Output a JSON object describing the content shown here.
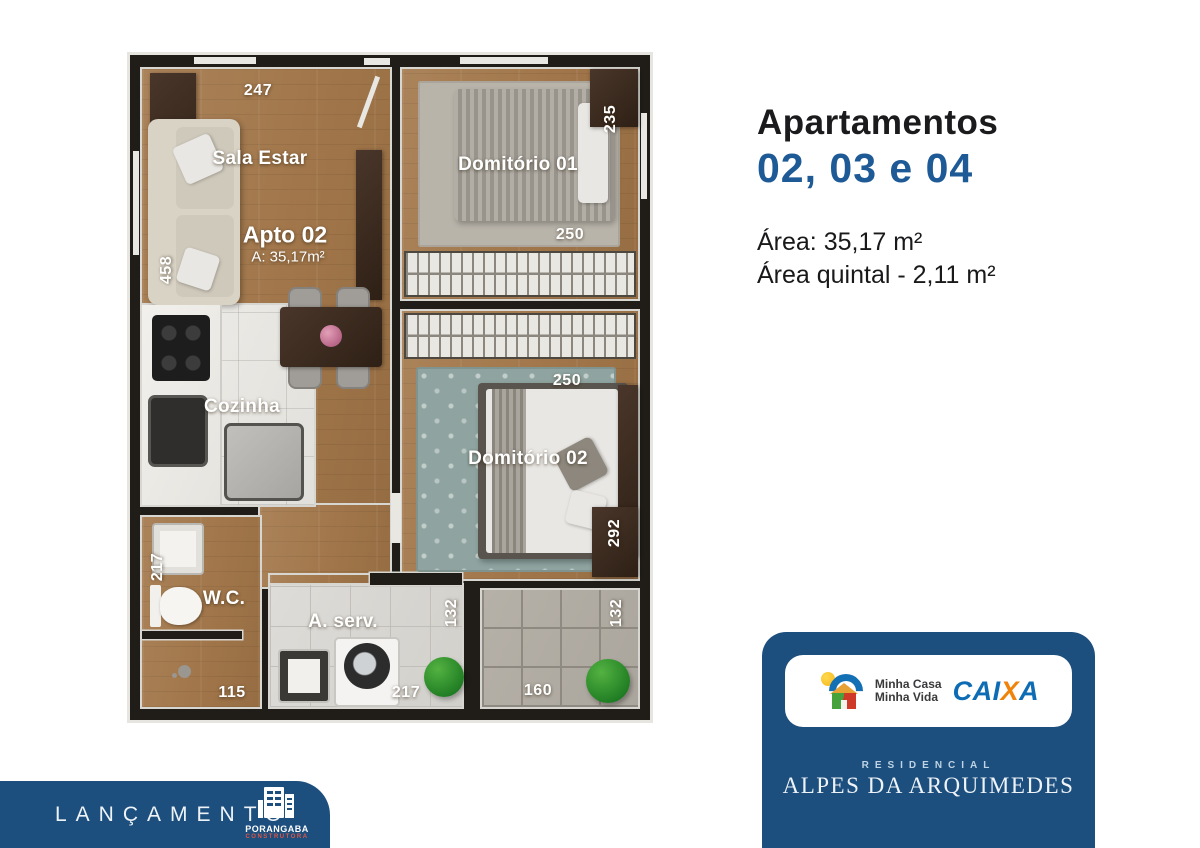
{
  "right_panel": {
    "title": "Apartamentos",
    "units": "02, 03 e 04",
    "area_line1": "Área: 35,17 m²",
    "area_line2": "Área quintal - 2,11 m²",
    "units_color": "#1e5a96"
  },
  "floorplan": {
    "labels": {
      "sala": "Sala Estar",
      "apto": "Apto 02",
      "apto_area": "A: 35,17m²",
      "dorm1": "Domitório 01",
      "dorm2": "Domitório 02",
      "cozinha": "Cozinha",
      "wc": "W.C.",
      "aserv": "A. serv."
    },
    "dims": {
      "sala_top": "247",
      "sala_left": "458",
      "dorm1_right": "235",
      "dorm1_closet": "250",
      "dorm2_closet": "250",
      "dorm2_right": "292",
      "wc_left": "217",
      "wc_bottom": "115",
      "aserv_bottom": "217",
      "aserv_right": "132",
      "patio_bottom": "160",
      "patio_right": "132"
    }
  },
  "brand_card": {
    "bg_color": "#1c4e7e",
    "mcmv_line1": "Minha Casa",
    "mcmv_line2": "Minha Vida",
    "caixa_parts": [
      "CAI",
      "X",
      "A"
    ],
    "caixa_blue": "#0e6cb4",
    "caixa_orange": "#f0830a",
    "residencial": "RESIDENCIAL",
    "name": "ALPES DA ARQUIMEDES"
  },
  "launch_banner": {
    "label": "LANÇAMENTO",
    "builder": "PORANGABA",
    "builder_sub": "CONSTRUTORA"
  }
}
